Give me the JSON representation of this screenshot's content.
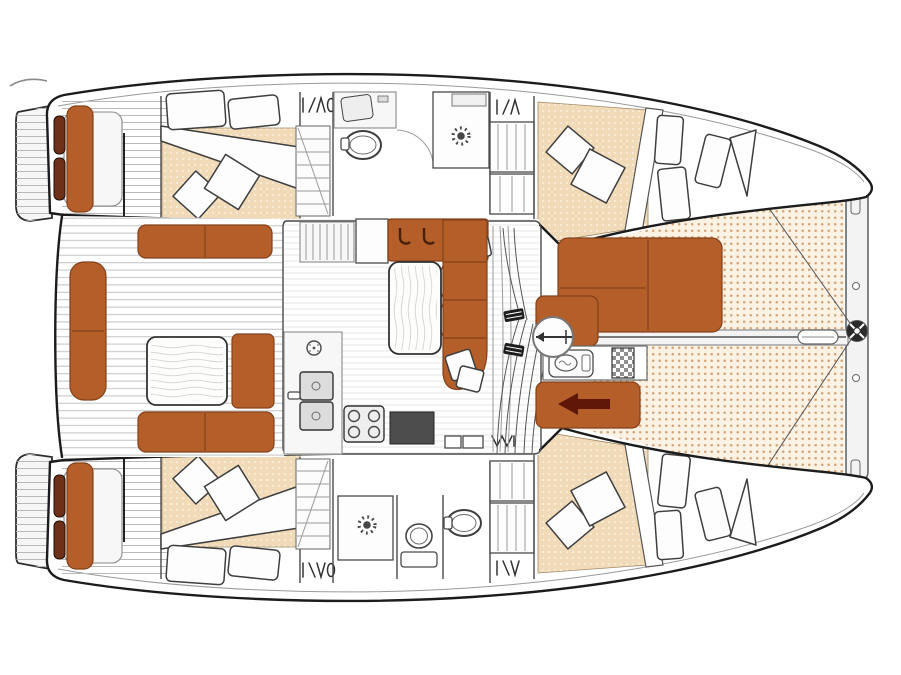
{
  "document": {
    "type": "boat-floor-plan",
    "subject": "Sailing catamaran deck and accommodation layout plan, top view, bow pointing right",
    "visible_text": []
  },
  "palette": {
    "outline": "#1c1c1c",
    "hull_fill": "#ffffff",
    "sheer_line": "#8f8f8f",
    "deck_plank": "#b9b9b9",
    "cockpit_plank": "#c8c8c8",
    "salon_plank": "#e4e4e4",
    "furniture_orange": "#b45e2a",
    "furniture_seam": "#84401a",
    "wheel_brown": "#6e3018",
    "bed_bg": "#f1dab8",
    "bed_dot": "#fbf0dd",
    "tramp_bg": "#fbf2e4",
    "tramp_dot": "#d2a377",
    "pillow_fill": "#fdfdfd",
    "pillow_stroke": "#3f3f3f",
    "appliance_dark": "#4d4d4d",
    "fixture_stroke": "#4a4a4a",
    "arrow_maroon": "#5f1708",
    "checker_gray": "#8f8f8f",
    "beam_fill": "#f3f3f3",
    "beam_stroke": "#9b9b9b",
    "table_grain": "#d9d9d3"
  },
  "icons": {
    "walkthrough_arrow": "left-pointing solid arrow",
    "mast_base": "circle with boom direction marker",
    "bow_fitting": "spoked hub circle",
    "shower_drain": "sunburst drain symbol",
    "stove_burners": "four burner circles",
    "sink_drain": "small circle",
    "hatch_symbol": "I-slash-caret opening-hatch mark",
    "deck_hatch": "checkerboard square",
    "hanger_locker": "striped wardrobe panel"
  },
  "layout_inventory": {
    "hulls": [
      "port",
      "starboard"
    ],
    "per_hull": [
      "swim-platform",
      "helm-seat",
      "steering-wheels",
      "aft-cabin-double-berth",
      "companionway-stairs",
      "bathroom",
      "hanging-locker",
      "forward-berth",
      "hatch-symbols"
    ],
    "center": [
      "aft-cockpit",
      "cockpit-benches",
      "cockpit-table",
      "salon",
      "galley-sink",
      "galley-stove",
      "salon-sofa",
      "salon-table",
      "mast-base",
      "forward-cockpit-seating",
      "sun-pad",
      "deck-hatch",
      "walkthrough-arrow",
      "trampoline-nets",
      "forward-crossbeam",
      "forestay"
    ]
  }
}
